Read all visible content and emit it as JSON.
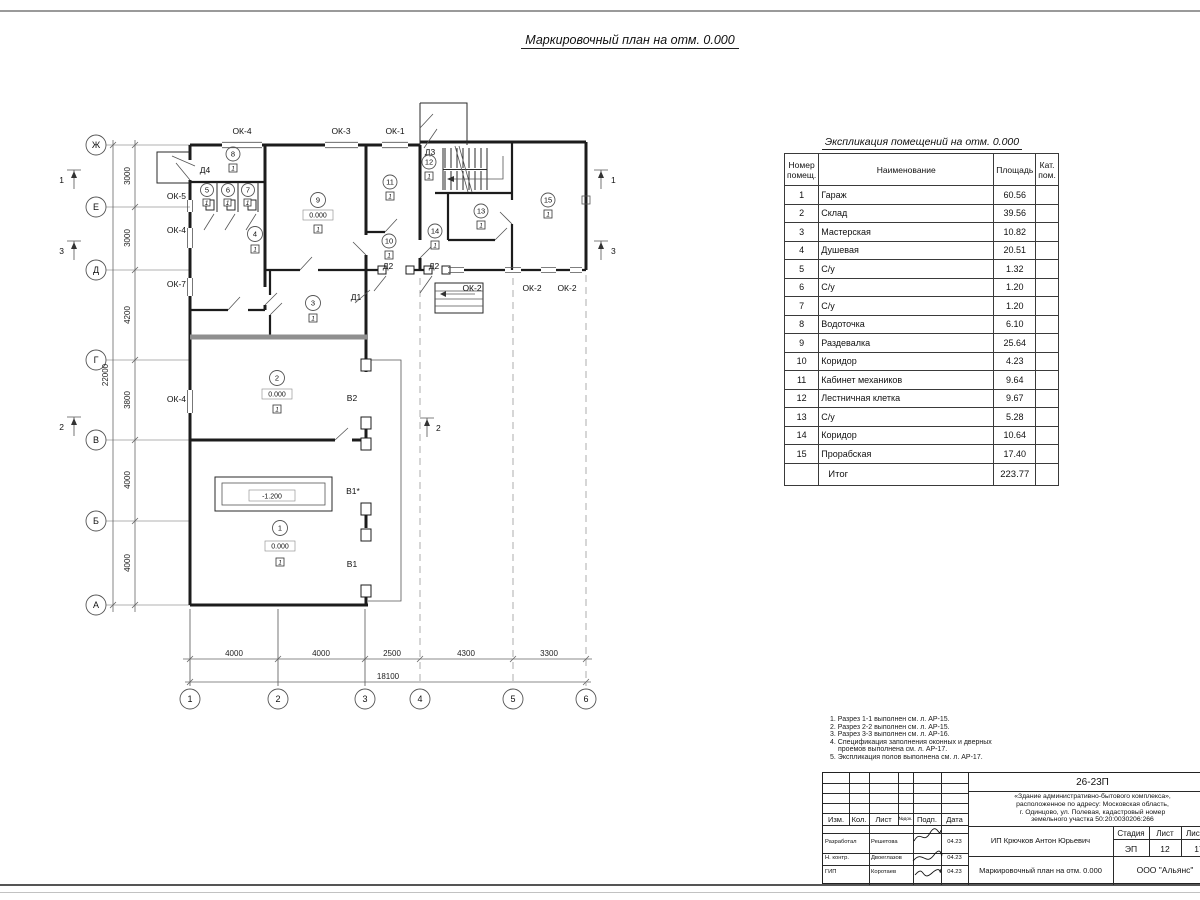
{
  "plan": {
    "title": "Маркировочный план на отм. 0.000",
    "axes_rows": [
      "Ж",
      "Е",
      "Д",
      "Г",
      "В",
      "Б",
      "А"
    ],
    "axes_cols": [
      "1",
      "2",
      "3",
      "4",
      "5",
      "6"
    ],
    "dims_left": [
      "3000",
      "3000",
      "4200",
      "3800",
      "4000",
      "4000"
    ],
    "dims_left_total": "22000",
    "dims_bottom": [
      "4000",
      "4000",
      "2500",
      "4300",
      "3300"
    ],
    "dims_bottom_total": "18100",
    "sections": {
      "one": "1",
      "two": "2",
      "three": "3"
    },
    "windows": [
      "ОК-4",
      "ОК-3",
      "ОК-1",
      "ОК-5",
      "ОК-4",
      "ОК-7",
      "ОК-4",
      "ОК-2",
      "ОК-2",
      "ОК-2"
    ],
    "doors": [
      "Д4",
      "Д3",
      "Д2",
      "Д2",
      "Д1"
    ],
    "gates": [
      "В2",
      "В1*",
      "В1"
    ],
    "level_zero": "0.000",
    "level_pit": "-1.200",
    "floor_mark": "1",
    "rooms": [
      {
        "num": "1"
      },
      {
        "num": "2"
      },
      {
        "num": "3"
      },
      {
        "num": "4"
      },
      {
        "num": "5"
      },
      {
        "num": "6"
      },
      {
        "num": "7"
      },
      {
        "num": "8"
      },
      {
        "num": "9"
      },
      {
        "num": "10"
      },
      {
        "num": "11"
      },
      {
        "num": "12"
      },
      {
        "num": "13"
      },
      {
        "num": "14"
      },
      {
        "num": "15"
      }
    ]
  },
  "explication": {
    "title": "Экспликация помещений на отм. 0.000",
    "headers": {
      "num": "Номер помещ.",
      "name": "Наименование",
      "area": "Площадь",
      "cat": "Кат. пом."
    },
    "rows": [
      {
        "num": "1",
        "name": "Гараж",
        "area": "60.56"
      },
      {
        "num": "2",
        "name": "Склад",
        "area": "39.56"
      },
      {
        "num": "3",
        "name": "Мастерская",
        "area": "10.82"
      },
      {
        "num": "4",
        "name": "Душевая",
        "area": "20.51"
      },
      {
        "num": "5",
        "name": "С/у",
        "area": "1.32"
      },
      {
        "num": "6",
        "name": "С/у",
        "area": "1.20"
      },
      {
        "num": "7",
        "name": "С/у",
        "area": "1.20"
      },
      {
        "num": "8",
        "name": "Водоточка",
        "area": "6.10"
      },
      {
        "num": "9",
        "name": "Раздевалка",
        "area": "25.64"
      },
      {
        "num": "10",
        "name": "Коридор",
        "area": "4.23"
      },
      {
        "num": "11",
        "name": "Кабинет механиков",
        "area": "9.64"
      },
      {
        "num": "12",
        "name": "Лестничная клетка",
        "area": "9.67"
      },
      {
        "num": "13",
        "name": "С/у",
        "area": "5.28"
      },
      {
        "num": "14",
        "name": "Коридор",
        "area": "10.64"
      },
      {
        "num": "15",
        "name": "Прорабская",
        "area": "17.40"
      }
    ],
    "total_label": "Итог",
    "total_area": "223.77"
  },
  "notes": {
    "lines": [
      "1. Разрез 1-1 выполнен см. л. АР-15.",
      "2. Разрез 2-2 выполнен см. л. АР-15.",
      "3. Разрез 3-3 выполнен см. л. АР-16.",
      "4. Спецификация заполнения оконных и дверных проемов выполнена см. л. АР-17.",
      "5. Экспликация полов выполнена см. л. АР-17."
    ]
  },
  "stamp": {
    "doc_number": "26-23П",
    "object_lines": [
      "«Здание административно-бытового комплекса»,",
      "расположенное по адресу: Московская область,",
      "г. Одинцово, ул. Полевая, кадастровый номер",
      "земельного участка 50:20:0030206:266"
    ],
    "cols": {
      "izm": "Изм.",
      "kol": "Кол.",
      "list": "Лист",
      "ndok": "№док.",
      "podp": "Подп.",
      "data": "Дата"
    },
    "roles": [
      {
        "role": "Разработал",
        "name": "Решетова",
        "date": "04.23"
      },
      {
        "role": "Н. контр.",
        "name": "Двоеглазов",
        "date": "04.23"
      },
      {
        "role": "ГИП",
        "name": "Коротаев",
        "date": "04.23"
      }
    ],
    "client": "ИП Крючков Антон Юрьевич",
    "stage_label": "Стадия",
    "sheet_label": "Лист",
    "sheets_label": "Листов",
    "stage": "ЭП",
    "sheet_no": "12",
    "sheets_total": "17",
    "sheet_title": "Маркировочный план на отм. 0.000",
    "company": "ООО \"Альянс\""
  }
}
